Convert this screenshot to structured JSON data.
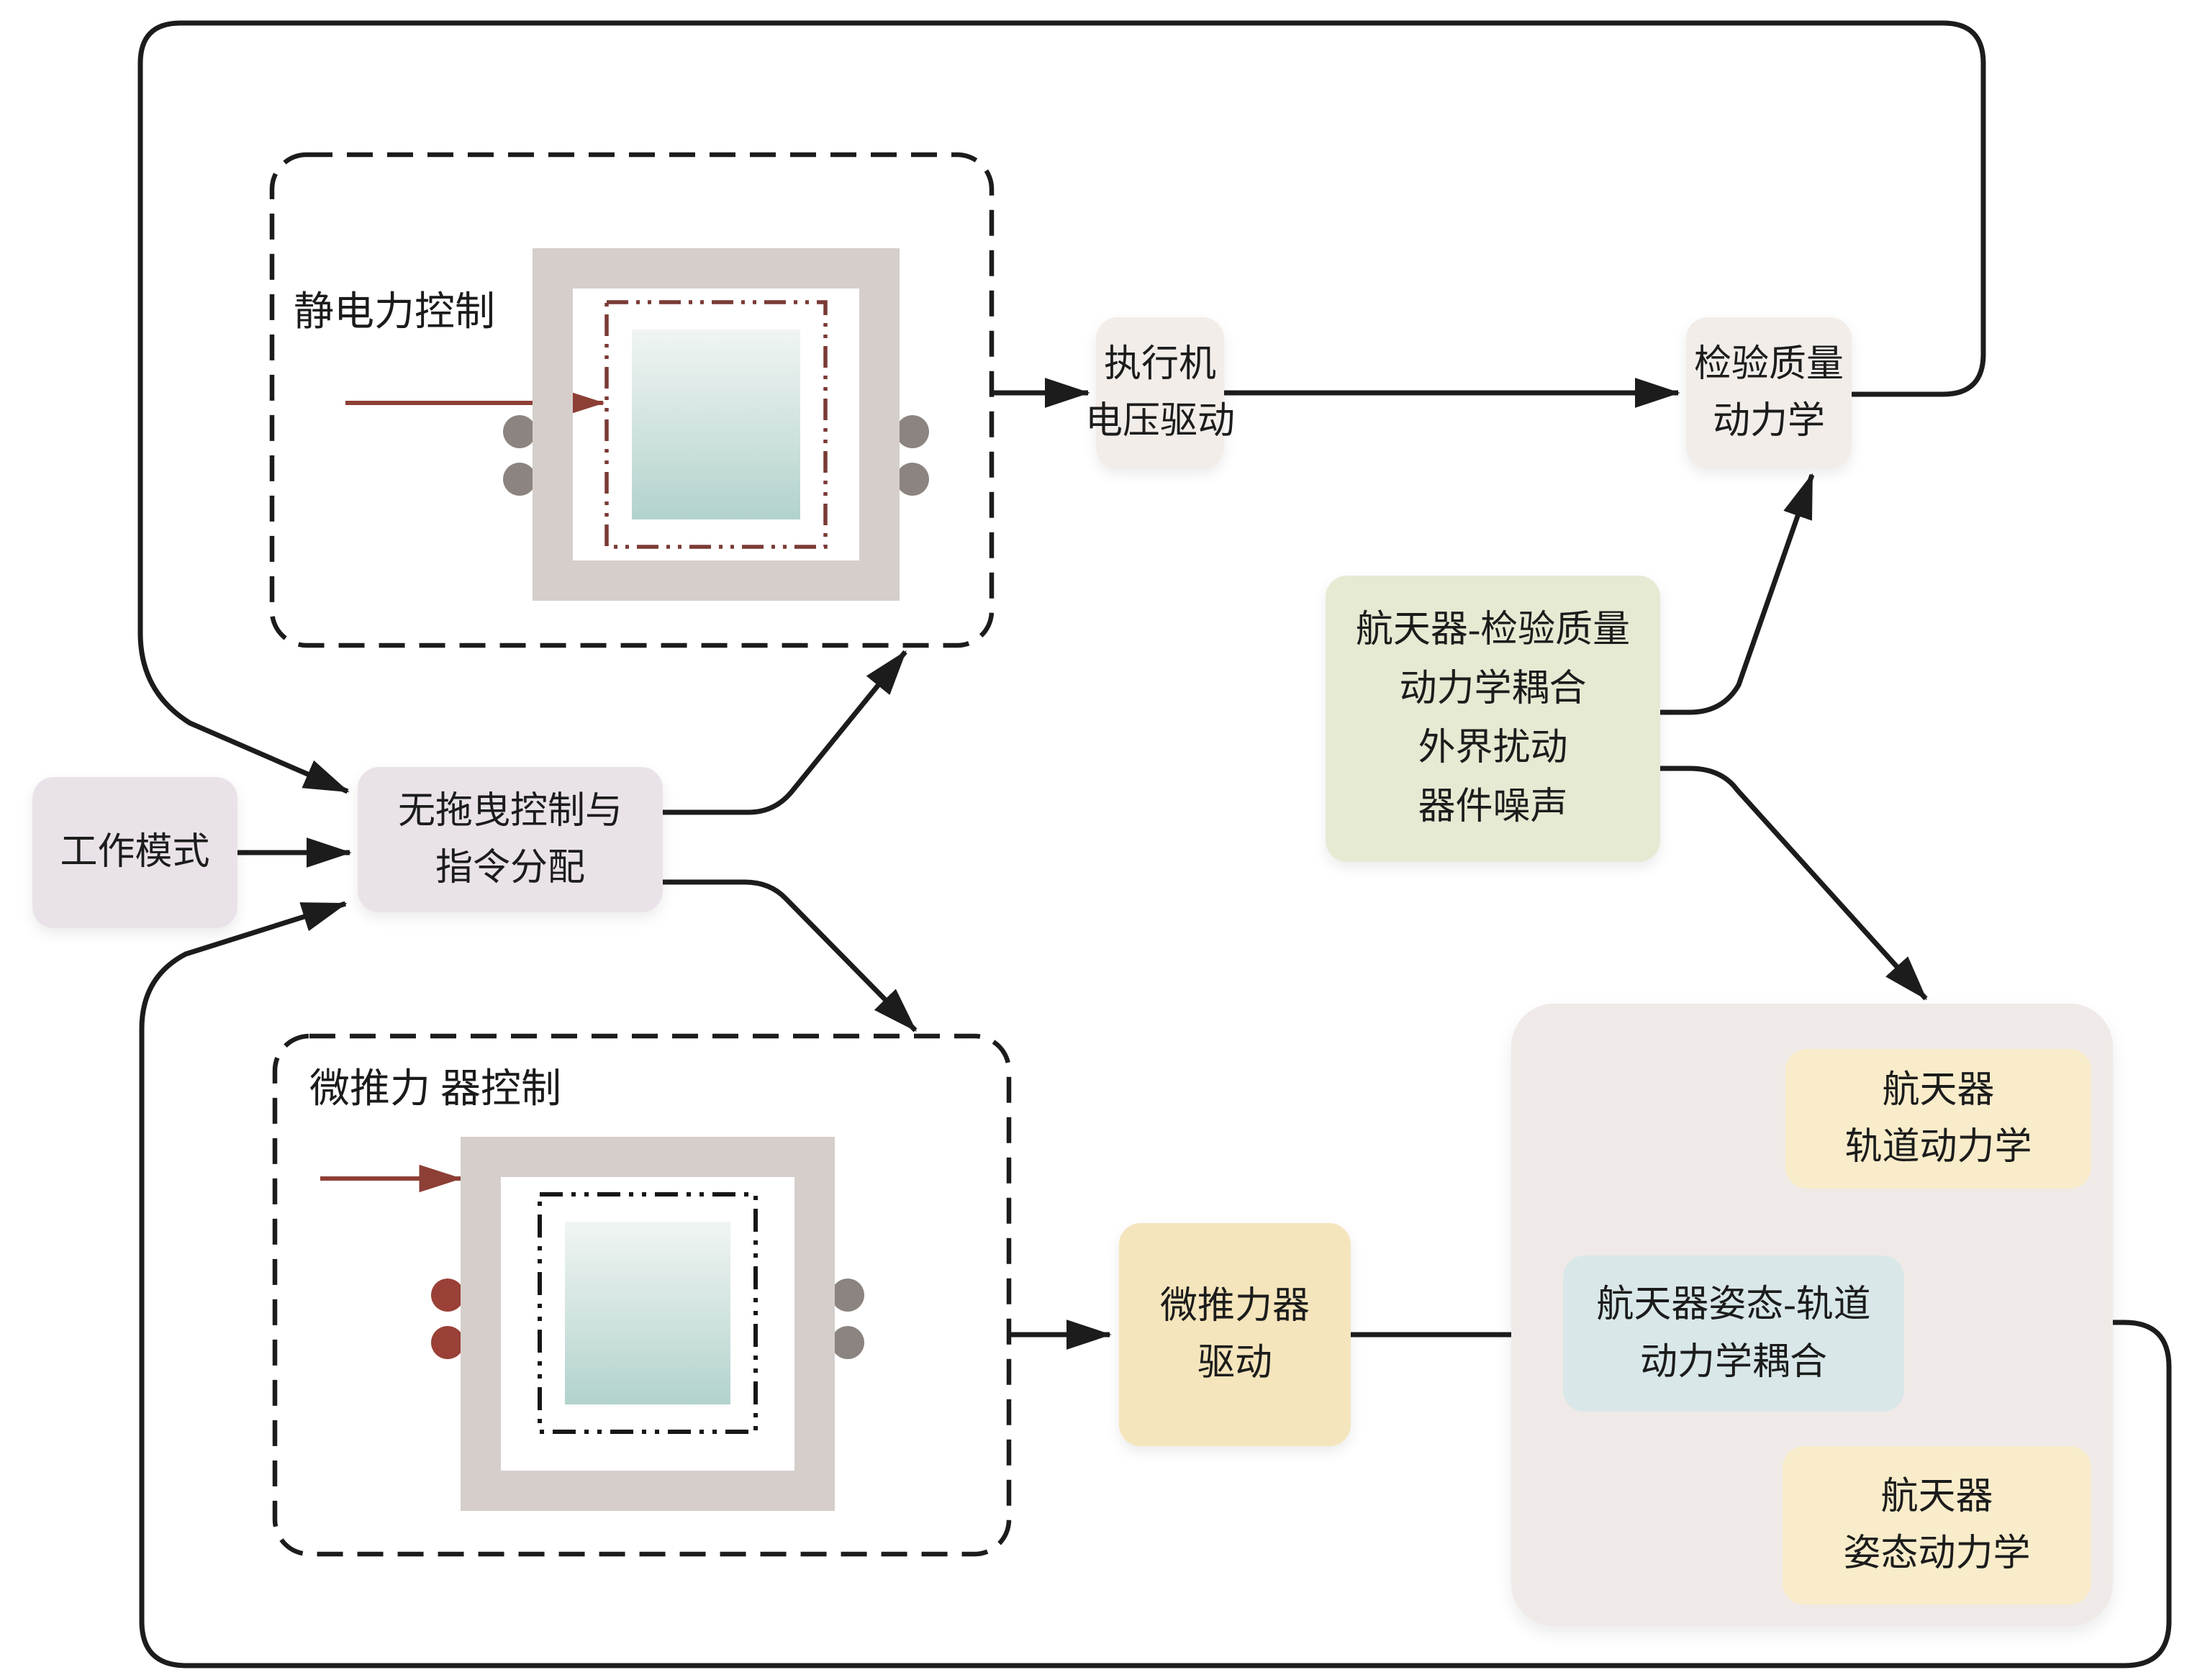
{
  "diagram": {
    "type": "flowchart",
    "subject": "drag-free spacecraft control loop",
    "nodes": {
      "work_mode": {
        "label": "工作模式"
      },
      "drag_free": {
        "line1": "无拖曳控制与",
        "line2": "指令分配"
      },
      "actuator": {
        "line1": "执行机",
        "line2": "电压驱动"
      },
      "test_mass": {
        "line1": "检验质量",
        "line2": "动力学"
      },
      "coupling_noise": {
        "line1": "航天器-检验质量",
        "line2": "动力学耦合",
        "line3": "外界扰动",
        "line4": "器件噪声"
      },
      "thruster_drive": {
        "line1": "微推力器",
        "line2": "驱动"
      },
      "orbit_dynamics": {
        "line1": "航天器",
        "line2": "轨道动力学"
      },
      "att_orbit_coupling": {
        "line1": "航天器姿态-轨道",
        "line2": "动力学耦合"
      },
      "attitude_dynamics": {
        "line1": "航天器",
        "line2": "姿态动力学"
      }
    },
    "annotations": {
      "electrostatic_control": {
        "label": "静电力控制"
      },
      "micro_thruster_control": {
        "line1": "微推力",
        "line2": "器控制"
      }
    },
    "connections": [
      {
        "from": "work_mode",
        "to": "drag_free"
      },
      {
        "from": "drag_free",
        "to": "electrostatic-sensor-box"
      },
      {
        "from": "drag_free",
        "to": "micro-thruster-sensor-box"
      },
      {
        "from": "electrostatic-sensor-box",
        "to": "actuator"
      },
      {
        "from": "actuator",
        "to": "test_mass"
      },
      {
        "from": "test_mass",
        "to": "drag_free",
        "type": "feedback-top-loop"
      },
      {
        "from": "coupling_noise",
        "to": "test_mass"
      },
      {
        "from": "coupling_noise",
        "to": "spacecraft-container"
      },
      {
        "from": "micro-thruster-sensor-box",
        "to": "thruster_drive"
      },
      {
        "from": "thruster_drive",
        "to": "att_orbit_coupling"
      },
      {
        "from": "att_orbit_coupling",
        "to": "orbit_dynamics"
      },
      {
        "from": "att_orbit_coupling",
        "to": "attitude_dynamics"
      },
      {
        "from": "spacecraft-container",
        "to": "drag_free",
        "type": "feedback-bottom-loop"
      }
    ]
  },
  "colors": {
    "line": "#1c1c1c",
    "accent_red": "#8d3f36",
    "lavender": "#eae2e9",
    "beige": "#f2ede9",
    "green": "#e6ead3",
    "yellow_deep": "#f5e5bc",
    "yellow_light": "#f8ecca",
    "blue": "#d9e7e9",
    "container": "#efeae7",
    "frame": "#d5cecb",
    "teal_light": "#f0f5f3",
    "teal_dark": "#b2d2ce",
    "dot_gray": "#8b8480",
    "dot_red": "#9a4037",
    "dash_red": "#7a3a35"
  }
}
